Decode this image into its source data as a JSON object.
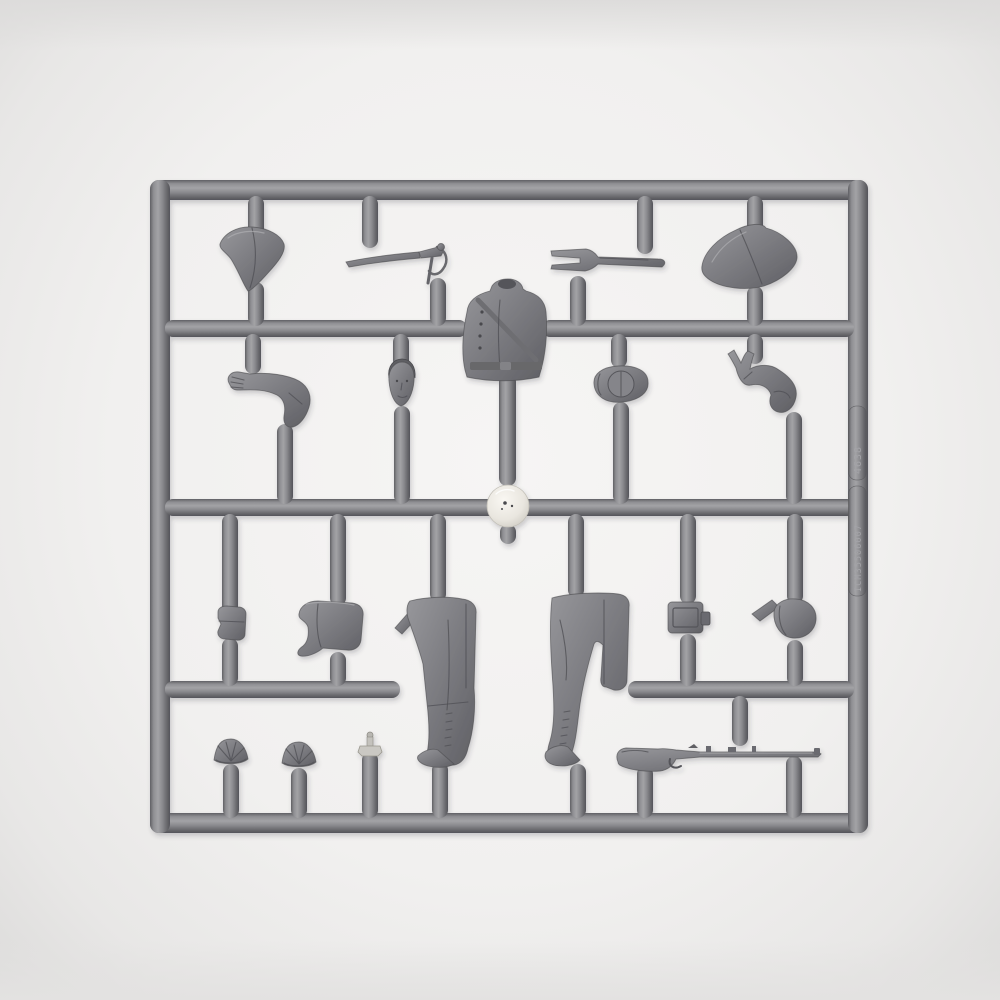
{
  "scene": {
    "type": "photograph",
    "description": "Grey polystyrene injection-moulded sprue (model-kit runner frame) holding parts for a Napoleonic-era soldier figure, photographed flat on a white surface",
    "background_color": "#f1f0ef",
    "plastic_color": "#85858a",
    "plastic_shadow_color": "#55555a",
    "plastic_highlight_color": "#a9a9ad",
    "gate_node_color": "#efede7"
  },
  "sprue": {
    "embossed_codes": {
      "upper": "4638",
      "lower": "ICM35506007"
    },
    "parts": [
      {
        "id": "bicorne-hat-left",
        "label": "Bicorne hat, point downward (top left)"
      },
      {
        "id": "sabre",
        "label": "Sabre with curved blade and hilt"
      },
      {
        "id": "scabbard-frog",
        "label": "Two-pronged scabbard frog / fork fitting"
      },
      {
        "id": "bicorne-hat-right",
        "label": "Bicorne hat, point leftward (top right)"
      },
      {
        "id": "torso",
        "label": "Torso in uniform coat with crossbelt"
      },
      {
        "id": "left-arm",
        "label": "Bent left arm with gripping hand"
      },
      {
        "id": "head",
        "label": "Bare head with face"
      },
      {
        "id": "round-cap",
        "label": "Round forage cap seen from above"
      },
      {
        "id": "right-hand",
        "label": "Right forearm with open hand"
      },
      {
        "id": "gate-node",
        "label": "Shiny injection-gate node at sprue centre"
      },
      {
        "id": "belt-pouch",
        "label": "Small belt pouch"
      },
      {
        "id": "saddle-flap",
        "label": "Curved flap / saddle piece"
      },
      {
        "id": "legs-standing",
        "label": "Legs in breeches with tall laced boots, standing"
      },
      {
        "id": "legs-striding",
        "label": "Legs in breeches with tall laced boots, striding"
      },
      {
        "id": "cartridge-box",
        "label": "Rectangular cartridge box"
      },
      {
        "id": "visor-cap",
        "label": "Forage cap with peak"
      },
      {
        "id": "epaulette-left",
        "label": "Fringed epaulette"
      },
      {
        "id": "epaulette-right",
        "label": "Fringed epaulette"
      },
      {
        "id": "small-finial",
        "label": "Small light-coloured finial part"
      },
      {
        "id": "musket",
        "label": "Musket with stock, barrel bands and trigger guard"
      }
    ]
  }
}
